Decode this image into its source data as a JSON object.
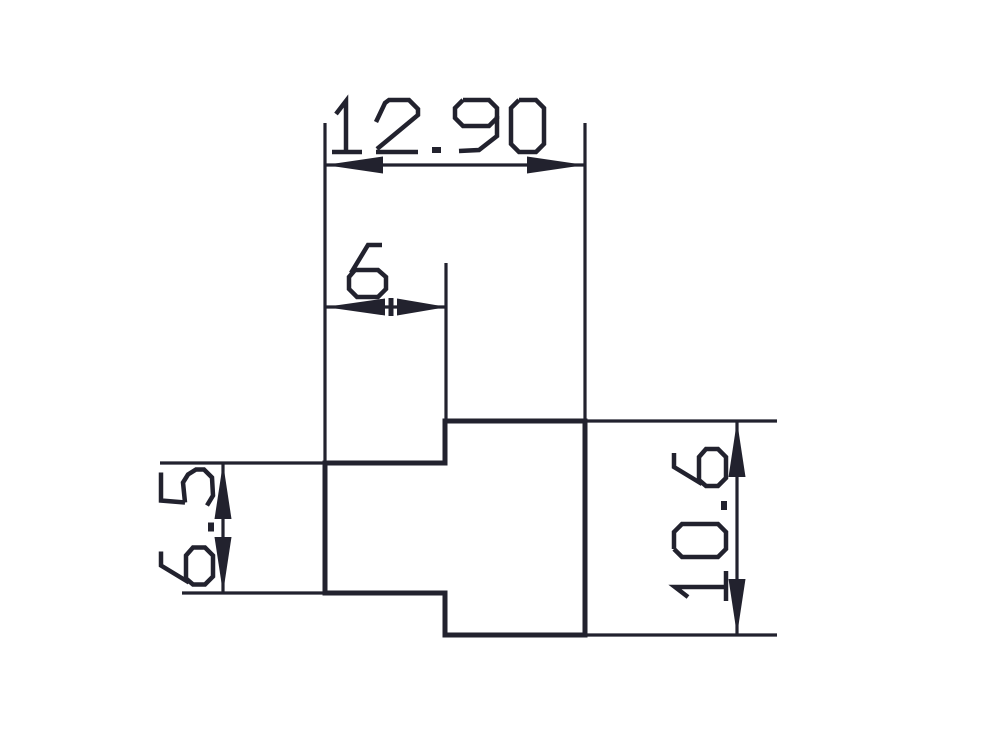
{
  "drawing": {
    "ink": "#22222e",
    "background": "#ffffff",
    "stroke_outline": 5,
    "stroke_thin": 3.2,
    "stroke_glyph": 4.5,
    "glyph_cap_height": 52,
    "glyph_gap": 14,
    "arrow_half_width": 8.5,
    "part_outline": [
      [
        325,
        463
      ],
      [
        445,
        463
      ],
      [
        445,
        421
      ],
      [
        585,
        421
      ],
      [
        585,
        635
      ],
      [
        445,
        635
      ],
      [
        445,
        593
      ],
      [
        325,
        593
      ]
    ],
    "dimensions": [
      {
        "name": "overall-width",
        "value": "12.90",
        "orientation": "horizontal",
        "ext": [
          [
            325,
            123,
            325,
            463
          ],
          [
            585,
            123,
            585,
            421
          ]
        ],
        "line": [
          325,
          165,
          585,
          165
        ],
        "arrows": [
          {
            "tip": [
              325,
              165
            ],
            "base": [
              383,
              165
            ]
          },
          {
            "tip": [
              585,
              165
            ],
            "base": [
              527,
              165
            ]
          }
        ],
        "ticks": [],
        "text": {
          "x": 332,
          "y": 152,
          "rotate": 0
        }
      },
      {
        "name": "tab-width",
        "value": "6",
        "orientation": "horizontal",
        "ext": [
          [
            446,
            263,
            446,
            421
          ]
        ],
        "line": [
          325,
          307,
          447,
          307
        ],
        "arrows": [
          {
            "tip": [
              325,
              307
            ],
            "base": [
              385,
              307
            ]
          },
          {
            "tip": [
              447,
              307
            ],
            "base": [
              397,
              307
            ]
          }
        ],
        "ticks": [
          [
            391,
            298,
            391,
            316
          ]
        ],
        "text": {
          "x": 348,
          "y": 297,
          "rotate": 0
        }
      },
      {
        "name": "tab-height",
        "value": "6.5",
        "orientation": "vertical",
        "ext": [
          [
            160,
            463,
            325,
            463
          ],
          [
            182,
            593,
            325,
            593
          ]
        ],
        "line": [
          223,
          463,
          223,
          593
        ],
        "arrows": [
          {
            "tip": [
              223,
              463
            ],
            "base": [
              223,
              519
            ]
          },
          {
            "tip": [
              223,
              593
            ],
            "base": [
              223,
              537
            ]
          }
        ],
        "ticks": [],
        "text": {
          "cx": 187,
          "cy": 527,
          "rotate": -90
        }
      },
      {
        "name": "overall-height",
        "value": "10.6",
        "orientation": "vertical",
        "ext": [
          [
            585,
            421,
            777,
            421
          ],
          [
            585,
            635,
            777,
            635
          ]
        ],
        "line": [
          737,
          421,
          737,
          635
        ],
        "arrows": [
          {
            "tip": [
              737,
              421
            ],
            "base": [
              737,
              477
            ]
          },
          {
            "tip": [
              737,
              635
            ],
            "base": [
              737,
              579
            ]
          }
        ],
        "ticks": [],
        "text": {
          "cx": 700,
          "cy": 524,
          "rotate": -90
        }
      }
    ]
  }
}
